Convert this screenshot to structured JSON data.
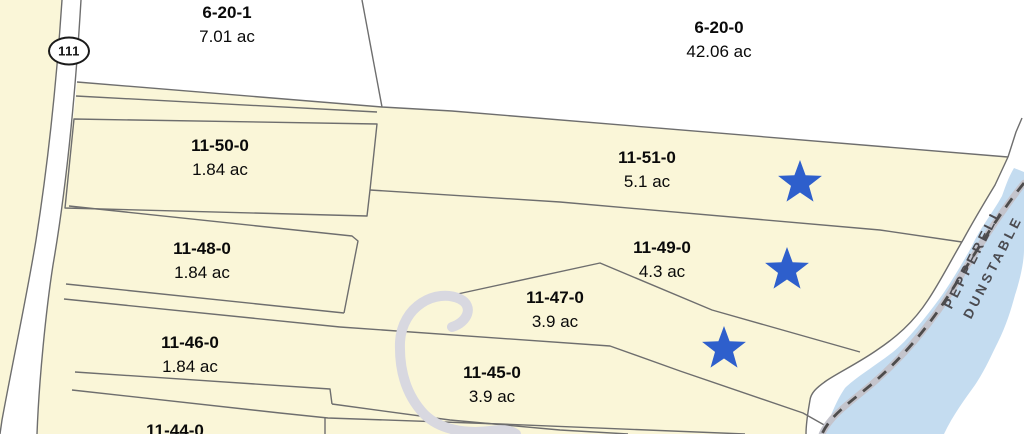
{
  "map": {
    "route_shield": {
      "number": "111"
    },
    "town_boundary": {
      "town_upper": "PEPPERELL",
      "town_lower": "DUNSTABLE"
    },
    "parcels": [
      {
        "id": "6-20-1",
        "acreage": "7.01 ac"
      },
      {
        "id": "6-20-0",
        "acreage": "42.06 ac"
      },
      {
        "id": "11-50-0",
        "acreage": "1.84 ac"
      },
      {
        "id": "11-51-0",
        "acreage": "5.1 ac"
      },
      {
        "id": "11-48-0",
        "acreage": "1.84 ac"
      },
      {
        "id": "11-49-0",
        "acreage": "4.3 ac"
      },
      {
        "id": "11-47-0",
        "acreage": "3.9 ac"
      },
      {
        "id": "11-46-0",
        "acreage": "1.84 ac"
      },
      {
        "id": "11-45-0",
        "acreage": "3.9 ac"
      },
      {
        "id": "11-44-0",
        "acreage": ""
      }
    ],
    "stars": [
      {
        "x": 800,
        "y": 183
      },
      {
        "x": 787,
        "y": 270
      },
      {
        "x": 724,
        "y": 349
      }
    ]
  },
  "colors": {
    "parcel_yellow": "#FAF6D8",
    "water_blue": "#C4DCF0",
    "line_gray": "#6E6E6E",
    "road_white": "#FFFFFF",
    "star_blue": "#2E5FCC",
    "stream_gray": "#D8D8E0",
    "boundary_dash_dark": "#4E4C4C",
    "boundary_band_gray": "#C4C4CC",
    "town_text_gray": "#4B4B50",
    "label_black": "#0A0A0A"
  }
}
